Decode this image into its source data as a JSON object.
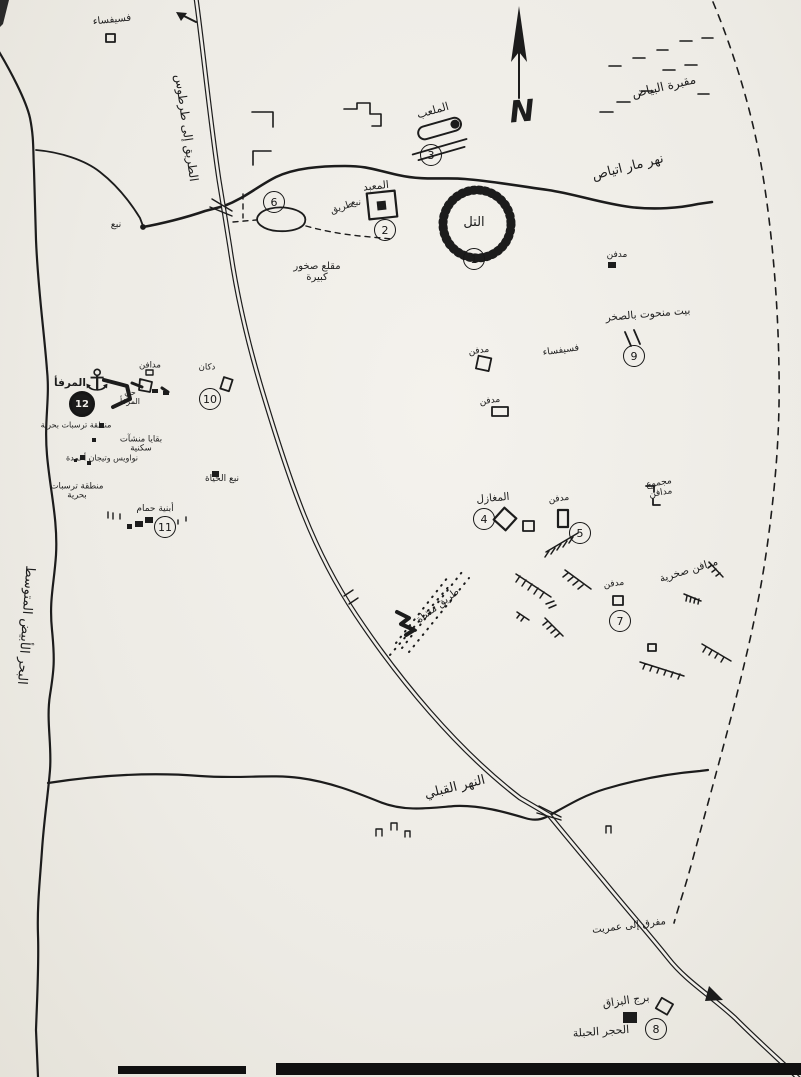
{
  "map_title": "Sketch map of the Amrit archaeological area",
  "compass": {
    "letter": "N"
  },
  "icons": {
    "anchor": "⚓"
  },
  "colors": {
    "ink": "#1c1c1c",
    "paper": "#efede8",
    "border": "#101010"
  },
  "labels": [
    {
      "name": "sea-name",
      "text": "البحر الأبيض المتوسط"
    },
    {
      "name": "road-to-tartus",
      "text": "الطريق إلى طرطوس"
    },
    {
      "name": "north-river",
      "text": "نهر مار اتياص"
    },
    {
      "name": "south-river",
      "text": "النهر القبلي"
    },
    {
      "name": "cemetery",
      "text": "مقبرة البياض"
    },
    {
      "name": "mosaic-top",
      "text": "فسيفساء"
    },
    {
      "name": "coast-spring",
      "text": "نبع"
    },
    {
      "name": "tell",
      "text": "التل"
    },
    {
      "name": "temple",
      "text": "المعبد"
    },
    {
      "name": "temple-spring",
      "text": "نبع"
    },
    {
      "name": "track",
      "text": "طريق"
    },
    {
      "name": "stadium",
      "text": "الملعب"
    },
    {
      "name": "quarry",
      "text": "مقلع صخور كبيرة"
    },
    {
      "name": "tomb-a",
      "text": "مدفن"
    },
    {
      "name": "rock-cut-house",
      "text": "بيت منحوت بالصخر"
    },
    {
      "name": "tomb-b",
      "text": "مدفن"
    },
    {
      "name": "mosaic-mid",
      "text": "فسيفساء"
    },
    {
      "name": "tomb-c",
      "text": "مدفن"
    },
    {
      "name": "maghazil",
      "text": "المغازل"
    },
    {
      "name": "tomb-d",
      "text": "مدفن"
    },
    {
      "name": "tomb-group",
      "text": "مجموع مدافن"
    },
    {
      "name": "rock-tombs",
      "text": "مدافن صخرية"
    },
    {
      "name": "tomb-e",
      "text": "مدفن"
    },
    {
      "name": "footpath",
      "text": "طريق مشاة"
    },
    {
      "name": "shop",
      "text": "دكان"
    },
    {
      "name": "tombs-10",
      "text": "مدافن"
    },
    {
      "name": "harbor",
      "text": "المرفأ"
    },
    {
      "name": "harbor-quarter",
      "text": "حي المرفأ"
    },
    {
      "name": "marine-deposits-1",
      "text": "منطقة ترسبات بحرية"
    },
    {
      "name": "residential-remains",
      "text": "بقايا منشآت سكنية"
    },
    {
      "name": "sarcophagi",
      "text": "نواويس وتيجان أعمدة"
    },
    {
      "name": "marine-deposits-2",
      "text": "منطقة ترسبات بحرية"
    },
    {
      "name": "life-spring",
      "text": "نبع الحياة"
    },
    {
      "name": "baths",
      "text": "أبنية حمام"
    },
    {
      "name": "amrit-junction",
      "text": "مفرق إلى عمريت"
    },
    {
      "name": "bezzaq-tower",
      "text": "برج البزاق"
    },
    {
      "name": "hajar-hable",
      "text": "الحجر الحبلة"
    }
  ],
  "markers": [
    {
      "number": "1"
    },
    {
      "number": "2"
    },
    {
      "number": "3"
    },
    {
      "number": "4"
    },
    {
      "number": "5"
    },
    {
      "number": "6"
    },
    {
      "number": "7"
    },
    {
      "number": "8"
    },
    {
      "number": "9"
    },
    {
      "number": "10"
    },
    {
      "number": "11"
    },
    {
      "number": "12"
    }
  ]
}
